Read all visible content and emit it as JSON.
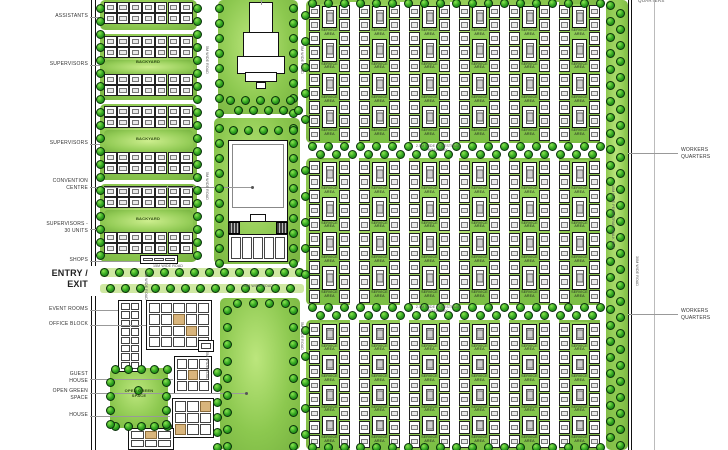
{
  "colors": {
    "panel_green": "#8cc84f",
    "tree_green": "#2da11f",
    "backyard_green": "#95cd58",
    "band_green": "#cfe8a2",
    "building_white": "#ffffff",
    "outline_black": "#111111",
    "tan_accent": "#d9b57c",
    "label_gray": "#333333",
    "leader_gray": "#999999"
  },
  "labels": {
    "left": [
      {
        "id": "assistants",
        "lines": "ASSISTANTS",
        "y": 13
      },
      {
        "id": "supervisors-1",
        "lines": "SUPERVISORS",
        "y": 61
      },
      {
        "id": "supervisors-2",
        "lines": "SUPERVISORS",
        "y": 140
      },
      {
        "id": "convention-centre",
        "lines": "CONVENTION\nCENTRE",
        "y": 178
      },
      {
        "id": "supervisors-30-units",
        "lines": "SUPERVISORS -\n30 UNITS",
        "y": 221
      },
      {
        "id": "shops",
        "lines": "SHOPS",
        "y": 257
      },
      {
        "id": "entry-exit",
        "lines": "ENTRY /\nEXIT",
        "y": 268,
        "big": true
      },
      {
        "id": "event-rooms",
        "lines": "EVENT ROOMS",
        "y": 306
      },
      {
        "id": "office-block",
        "lines": "OFFICE BLOCK",
        "y": 321
      },
      {
        "id": "guest-house",
        "lines": "GUEST\nHOUSE",
        "y": 371
      },
      {
        "id": "open-green-space",
        "lines": "OPEN GREEN\nSPACE",
        "y": 388
      },
      {
        "id": "house",
        "lines": "HOUSE",
        "y": 412
      }
    ],
    "right": [
      {
        "id": "workers-quarters-1",
        "lines": "WORKERS\nQUARTERS",
        "y": 147
      },
      {
        "id": "workers-quarters-2",
        "lines": "WORKERS\nQUARTERS",
        "y": 308
      }
    ],
    "top_right_partial": "QUARTERS"
  },
  "plan_texts": {
    "backyard": {
      "text": "BACKYARD",
      "positions": [
        [
          148,
          63
        ],
        [
          148,
          140
        ],
        [
          148,
          220
        ]
      ]
    },
    "open_green_inner": {
      "text": "OPEN GREEN\nSPACE",
      "x": 139,
      "y": 393
    },
    "service_area": "SERVICE\nAREA"
  },
  "road_labels": [
    {
      "t": "15M WIDE ROAD",
      "x": 148,
      "y": 264,
      "w": 40
    },
    {
      "t": "15M WIDE ROAD",
      "x": 238,
      "y": 284,
      "w": 40
    },
    {
      "t": "2.5M WIDE PEDESTRIAN\nWALK WAY",
      "x": 408,
      "y": 144,
      "w": 60
    },
    {
      "t": "2.5M WIDE PEDESTRIAN\nWALK WAY",
      "x": 408,
      "y": 305,
      "w": 60
    },
    {
      "t": "5M WIDE ROAD",
      "x": 205,
      "y": 46,
      "vert": true
    },
    {
      "t": "5M WIDE ROAD",
      "x": 300,
      "y": 46,
      "vert": true
    },
    {
      "t": "5M WIDE ROAD",
      "x": 205,
      "y": 172,
      "vert": true
    },
    {
      "t": "5M WIDE ROAD",
      "x": 205,
      "y": 352,
      "vert": true
    },
    {
      "t": "5M WIDE ROAD",
      "x": 300,
      "y": 322,
      "vert": true
    },
    {
      "t": "5M WIDE ROAD",
      "x": 144,
      "y": 272,
      "vert": true
    },
    {
      "t": "10M WIDE PEDESTRIAN WALK WAY",
      "x": 611,
      "y": 185,
      "vert": true
    },
    {
      "t": "30M WIDE ROAD",
      "x": 635,
      "y": 256,
      "vert": true
    }
  ],
  "panels": [
    {
      "n": "assistants-block",
      "x": 100,
      "y": 0,
      "w": 97,
      "h": 30
    },
    {
      "n": "supervisors-block-1",
      "x": 100,
      "y": 34,
      "w": 97,
      "h": 66
    },
    {
      "n": "supervisors-block-2",
      "x": 100,
      "y": 104,
      "w": 97,
      "h": 76
    },
    {
      "n": "supervisors-block-3",
      "x": 100,
      "y": 184,
      "w": 97,
      "h": 78
    },
    {
      "n": "temple-green",
      "x": 218,
      "y": 0,
      "w": 80,
      "h": 114
    },
    {
      "n": "convention-green",
      "x": 214,
      "y": 118,
      "w": 86,
      "h": 146
    },
    {
      "n": "central-park",
      "x": 220,
      "y": 298,
      "w": 80,
      "h": 152
    },
    {
      "n": "open-green-space",
      "x": 110,
      "y": 368,
      "w": 58,
      "h": 60
    },
    {
      "n": "workers-row-1",
      "x": 306,
      "y": 0,
      "w": 300,
      "h": 143
    },
    {
      "n": "workers-row-2",
      "x": 306,
      "y": 158,
      "w": 300,
      "h": 147
    },
    {
      "n": "workers-row-3",
      "x": 306,
      "y": 320,
      "w": 300,
      "h": 130
    },
    {
      "n": "east-walkway-strip",
      "x": 606,
      "y": 0,
      "w": 22,
      "h": 450
    }
  ],
  "backyards": [
    [
      104,
      60,
      89,
      14
    ],
    [
      104,
      130,
      89,
      22
    ],
    [
      104,
      210,
      89,
      22
    ]
  ],
  "bands": [
    [
      100,
      268,
      204,
      9
    ],
    [
      100,
      284,
      204,
      9
    ]
  ],
  "housing_strips": [
    {
      "x": 104,
      "y": 2,
      "cells": 7,
      "rows": 2
    },
    {
      "x": 104,
      "y": 36,
      "cells": 7,
      "rows": 2
    },
    {
      "x": 104,
      "y": 74,
      "cells": 7,
      "rows": 2
    },
    {
      "x": 104,
      "y": 106,
      "cells": 7,
      "rows": 2
    },
    {
      "x": 104,
      "y": 152,
      "cells": 7,
      "rows": 2
    },
    {
      "x": 104,
      "y": 186,
      "cells": 7,
      "rows": 2
    },
    {
      "x": 104,
      "y": 232,
      "cells": 7,
      "rows": 2
    }
  ],
  "housing_cell": {
    "w": 12.7,
    "h": 11
  },
  "workers": {
    "rows": [
      {
        "y": 4,
        "h": 139,
        "units": 10
      },
      {
        "y": 160,
        "h": 145,
        "units": 10
      },
      {
        "y": 322,
        "h": 128,
        "units": 9
      }
    ],
    "groups": 6,
    "gx0": 309,
    "pitch": 50,
    "unit_w": 11,
    "court_w": 19,
    "services": 4
  },
  "buildings": [
    {
      "n": "event-rooms-building",
      "x": 118,
      "y": 300,
      "w": 24,
      "h": 72,
      "cols": 2,
      "rows": 8,
      "tan": []
    },
    {
      "n": "office-block-building",
      "x": 146,
      "y": 300,
      "w": 66,
      "h": 50,
      "cols": 5,
      "rows": 4,
      "tan": [
        7,
        13
      ]
    },
    {
      "n": "annex-building",
      "x": 198,
      "y": 340,
      "w": 16,
      "h": 12,
      "cols": 1,
      "rows": 1,
      "tan": []
    },
    {
      "n": "guest-house-building",
      "x": 174,
      "y": 356,
      "w": 38,
      "h": 38,
      "cols": 3,
      "rows": 3,
      "tan": [
        4
      ]
    },
    {
      "n": "house-building-a",
      "x": 172,
      "y": 398,
      "w": 42,
      "h": 40,
      "cols": 3,
      "rows": 3,
      "tan": [
        2,
        6
      ]
    },
    {
      "n": "house-building-b",
      "x": 128,
      "y": 428,
      "w": 46,
      "h": 22,
      "cols": 3,
      "rows": 2,
      "tan": [
        1
      ]
    },
    {
      "n": "shops-row",
      "x": 228,
      "y": 234,
      "w": 60,
      "h": 28,
      "cols": 5,
      "rows": 1,
      "tan": []
    },
    {
      "n": "shops-kiosk",
      "x": 140,
      "y": 255,
      "w": 38,
      "h": 9,
      "cols": 3,
      "rows": 1,
      "tan": []
    }
  ],
  "special_rects": [
    {
      "n": "temple-top",
      "cls": "white-rect",
      "x": 249,
      "y": 2,
      "w": 24,
      "h": 32
    },
    {
      "n": "temple-mid",
      "cls": "white-rect",
      "x": 243,
      "y": 32,
      "w": 36,
      "h": 26
    },
    {
      "n": "temple-wide",
      "cls": "white-rect",
      "x": 237,
      "y": 56,
      "w": 48,
      "h": 18
    },
    {
      "n": "temple-base",
      "cls": "white-rect",
      "x": 245,
      "y": 72,
      "w": 32,
      "h": 10
    },
    {
      "n": "temple-door",
      "cls": "white-rect",
      "x": 256,
      "y": 82,
      "w": 10,
      "h": 7
    },
    {
      "n": "convention-building",
      "cls": "white-rect",
      "x": 228,
      "y": 140,
      "w": 60,
      "h": 82
    },
    {
      "n": "convention-inner",
      "cls": "thin-rect",
      "x": 232,
      "y": 144,
      "w": 52,
      "h": 64
    },
    {
      "n": "convention-stub",
      "cls": "white-rect",
      "x": 250,
      "y": 214,
      "w": 16,
      "h": 8
    },
    {
      "n": "convention-wing-left",
      "cls": "dark-rect",
      "x": 228,
      "y": 222,
      "w": 12,
      "h": 12
    },
    {
      "n": "convention-wing-right",
      "cls": "dark-rect",
      "x": 276,
      "y": 222,
      "w": 12,
      "h": 12
    }
  ],
  "walls": [
    {
      "n": "west-boundary-a",
      "x": 91,
      "y": 0,
      "w": 1,
      "h": 266
    },
    {
      "n": "west-boundary-a2",
      "x": 91,
      "y": 296,
      "w": 1,
      "h": 154
    },
    {
      "n": "west-boundary-b",
      "x": 95,
      "y": 0,
      "w": 1,
      "h": 266
    },
    {
      "n": "west-boundary-b2",
      "x": 95,
      "y": 296,
      "w": 1,
      "h": 154
    },
    {
      "n": "east-boundary-a",
      "x": 628,
      "y": 0,
      "w": 1,
      "h": 450
    },
    {
      "n": "east-boundary-b",
      "x": 631,
      "y": 0,
      "w": 1,
      "h": 450
    }
  ],
  "graylines": [
    {
      "x": 654,
      "y": 0,
      "w": 1,
      "h": 450
    }
  ],
  "leaders": [
    [
      90,
      17,
      100,
      17
    ],
    [
      90,
      65,
      100,
      65
    ],
    [
      90,
      144,
      100,
      144
    ],
    [
      90,
      187,
      252,
      187
    ],
    [
      90,
      229,
      100,
      229
    ],
    [
      90,
      261,
      140,
      261
    ],
    [
      90,
      310,
      118,
      310
    ],
    [
      90,
      325,
      146,
      325
    ],
    [
      90,
      379,
      173,
      379
    ],
    [
      90,
      393,
      246,
      393
    ],
    [
      90,
      416,
      170,
      416
    ],
    [
      628,
      153,
      678,
      153
    ],
    [
      628,
      314,
      678,
      314
    ],
    [
      261,
      0,
      261,
      5
    ]
  ],
  "dots": [
    [
      252,
      187
    ],
    [
      246,
      393
    ]
  ],
  "trees": [
    {
      "x": 100,
      "y": 8,
      "dx": 0,
      "dy": 13,
      "n": 20
    },
    {
      "x": 197,
      "y": 8,
      "dx": 0,
      "dy": 13,
      "n": 20
    },
    {
      "x": 219,
      "y": 8,
      "dx": 0,
      "dy": 15,
      "n": 18
    },
    {
      "x": 293,
      "y": 8,
      "dx": 0,
      "dy": 15,
      "n": 18
    },
    {
      "x": 233,
      "y": 130,
      "dx": 15,
      "dy": 0,
      "n": 5
    },
    {
      "x": 230,
      "y": 100,
      "dx": 15,
      "dy": 0,
      "n": 5
    },
    {
      "x": 238,
      "y": 110,
      "dx": 15,
      "dy": 0,
      "n": 5
    },
    {
      "x": 104,
      "y": 272,
      "dx": 15,
      "dy": 0,
      "n": 14
    },
    {
      "x": 110,
      "y": 288,
      "dx": 15,
      "dy": 0,
      "n": 13
    },
    {
      "x": 312,
      "y": 3,
      "dx": 16,
      "dy": 0,
      "n": 19
    },
    {
      "x": 312,
      "y": 146,
      "dx": 16,
      "dy": 0,
      "n": 19
    },
    {
      "x": 320,
      "y": 154,
      "dx": 16,
      "dy": 0,
      "n": 18
    },
    {
      "x": 312,
      "y": 307,
      "dx": 16,
      "dy": 0,
      "n": 19
    },
    {
      "x": 320,
      "y": 315,
      "dx": 16,
      "dy": 0,
      "n": 18
    },
    {
      "x": 312,
      "y": 447,
      "dx": 16,
      "dy": 0,
      "n": 19
    },
    {
      "x": 610,
      "y": 5,
      "dx": 0,
      "dy": 16,
      "n": 28
    },
    {
      "x": 620,
      "y": 13,
      "dx": 0,
      "dy": 16,
      "n": 28
    },
    {
      "x": 305,
      "y": 15,
      "dx": 0,
      "dy": 26,
      "n": 5
    },
    {
      "x": 305,
      "y": 170,
      "dx": 0,
      "dy": 26,
      "n": 5
    },
    {
      "x": 305,
      "y": 330,
      "dx": 0,
      "dy": 26,
      "n": 5
    },
    {
      "x": 227,
      "y": 310,
      "dx": 0,
      "dy": 17,
      "n": 9
    },
    {
      "x": 293,
      "y": 310,
      "dx": 0,
      "dy": 17,
      "n": 9
    },
    {
      "x": 237,
      "y": 303,
      "dx": 16,
      "dy": 0,
      "n": 4
    },
    {
      "x": 115,
      "y": 369,
      "dx": 13,
      "dy": 0,
      "n": 5
    },
    {
      "x": 115,
      "y": 426,
      "dx": 13,
      "dy": 0,
      "n": 5
    },
    {
      "x": 110,
      "y": 382,
      "dx": 0,
      "dy": 14,
      "n": 4
    },
    {
      "x": 166,
      "y": 382,
      "dx": 0,
      "dy": 14,
      "n": 4
    },
    {
      "x": 138,
      "y": 390,
      "dx": 0,
      "dy": 0,
      "n": 1
    },
    {
      "x": 217,
      "y": 372,
      "dx": 0,
      "dy": 15,
      "n": 6
    }
  ]
}
